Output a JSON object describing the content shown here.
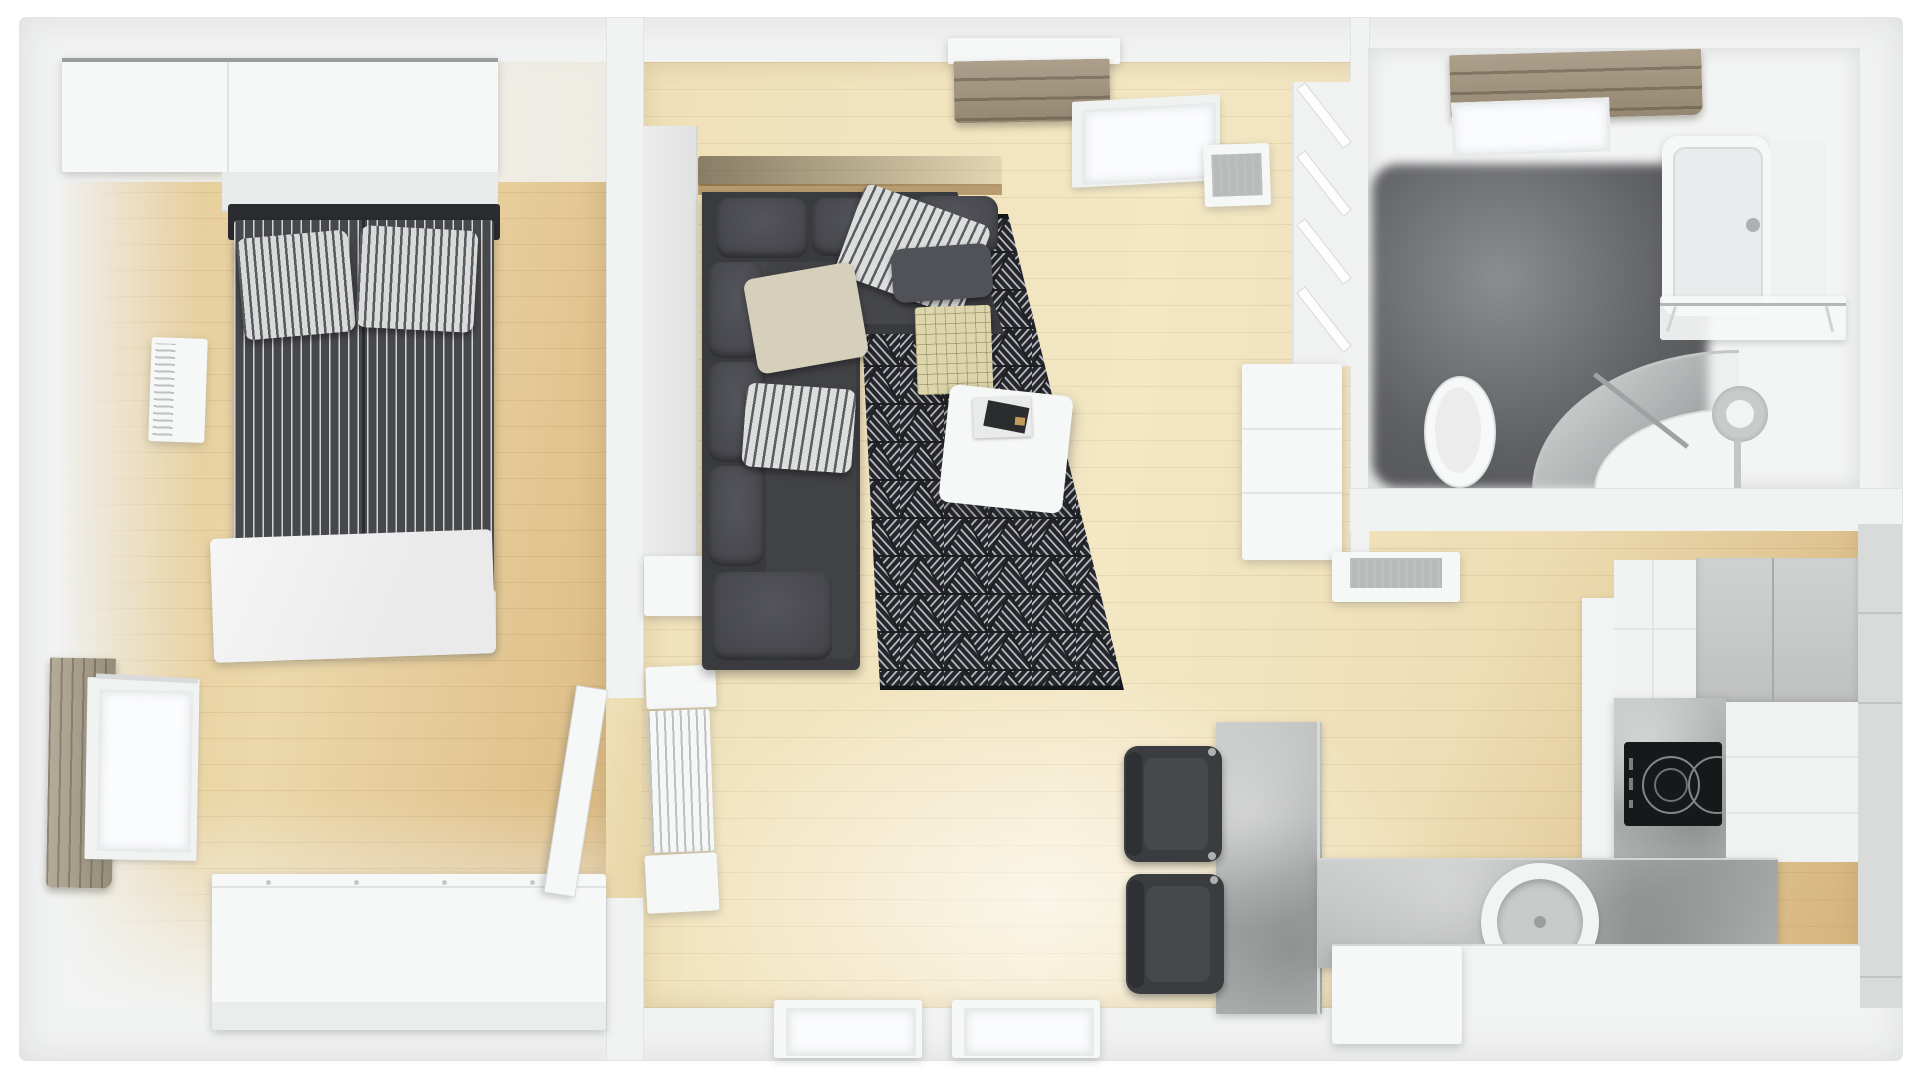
{
  "meta": {
    "title": "Apartment 3D floor plan - top-down render",
    "view": "top-down 3D architectural visualization",
    "text_content": "none (image contains no text)"
  },
  "palette": {
    "wall": "#f1f2f2",
    "wallEdge": "#e2e4e4",
    "whiteFurn": "#f6f7f7",
    "woodBedA": "#e3c691",
    "woodBedB": "#ecd8aa",
    "woodLivA": "#efe0b8",
    "woodLivB": "#e8d3a2",
    "woodDeep": "#c49a5e",
    "rugBase": "#1e1f23",
    "rugHatch": "#cdced3",
    "sofa": "#3a3b3e",
    "sofaCushion": "#54555b",
    "duvet": "#47484c",
    "headboard": "#2b2c2f",
    "taupe": "#ac9f8b",
    "taupeDark": "#948872",
    "concreteA": "#c6c8c8",
    "concreteB": "#a7a9a9",
    "grayCab": "#c8cac9",
    "bathFloorA": "#8b8d90",
    "bathFloorB": "#525356",
    "cooktop": "#17181a",
    "glass": "#fbfcfe",
    "chrome": "#aeb0b2",
    "chairDark": "#3b3c3f"
  },
  "rooms": [
    {
      "id": "bedroom",
      "name": "Bedroom",
      "floor": "light oak plank floor",
      "items": [
        "wardrobe",
        "headboard ledge",
        "double bed with dark striped duvet",
        "two striped pillows",
        "white throw blanket at bed foot",
        "wall shelf radiator",
        "window with taupe curtain",
        "white dresser",
        "open door leaf"
      ]
    },
    {
      "id": "living-room",
      "name": "Living room",
      "floor": "pale oak plank floor",
      "items": [
        "dark gray corner sofa",
        "striped accent pillows",
        "beige pillow",
        "plaid throw",
        "black geometric triangle rug",
        "white coffee table with magazines",
        "tall left cabinet",
        "slatted radiator with shelves",
        "side table",
        "roman blind window on top wall",
        "window sill radiator",
        "leaning shelf unit",
        "white sideboard",
        "low cabinet with gray inset",
        "two windows on bottom wall"
      ]
    },
    {
      "id": "bathroom",
      "name": "Bathroom",
      "floor": "dark gray tile floor",
      "items": [
        "roman blind skylight window",
        "bathtub with faucet",
        "towel shelf with rail",
        "curved corner shower with glass",
        "toilet",
        "toilet paper holder with pipe"
      ]
    },
    {
      "id": "kitchen-dining",
      "name": "Kitchen / dining",
      "floor": "oak plank floor",
      "items": [
        "concrete dining table",
        "two dark chairs with chrome hinges",
        "L-shaped counter with concrete top",
        "round white sink",
        "black induction cooktop with two burners",
        "tall gray cabinets",
        "white cabinet runs",
        "white bench"
      ]
    }
  ]
}
